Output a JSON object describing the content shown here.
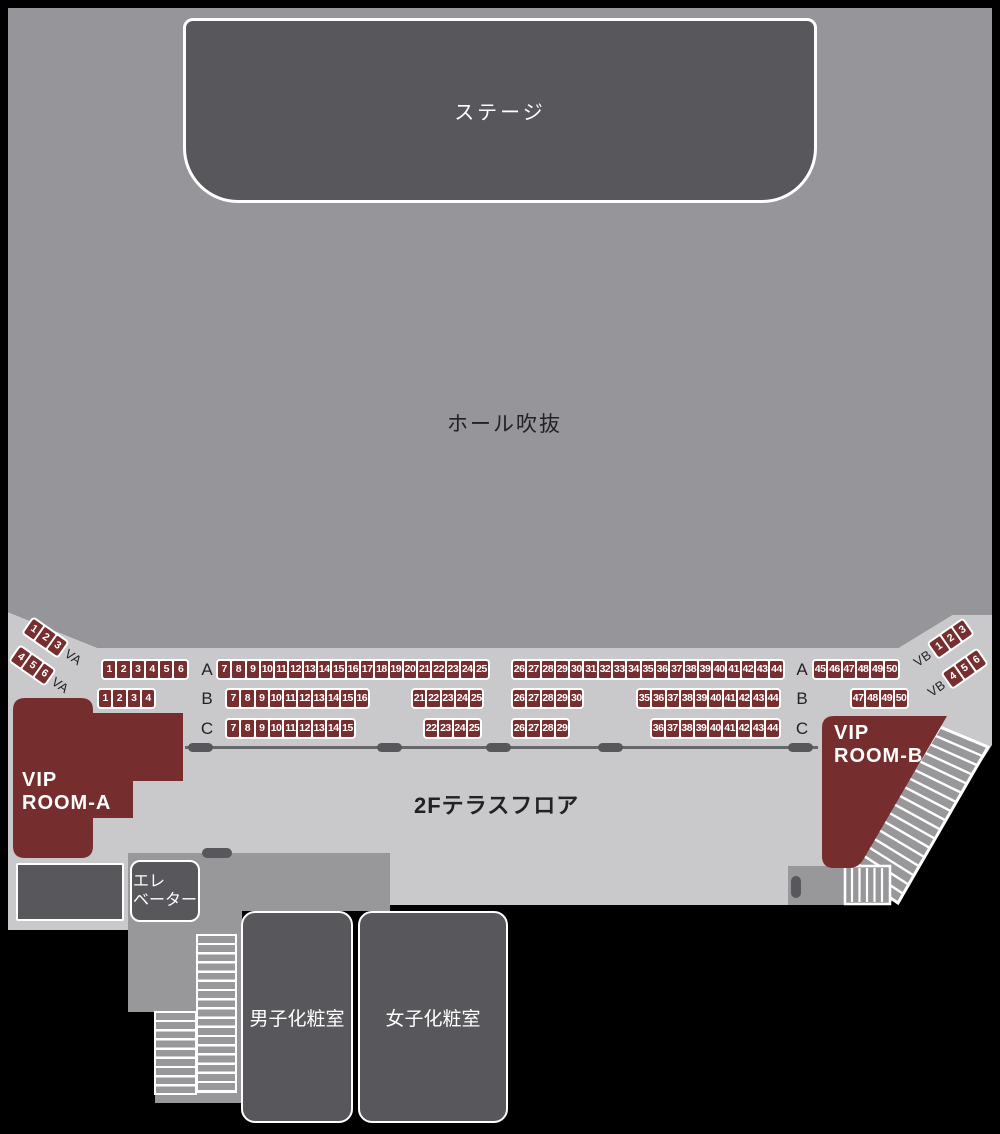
{
  "stage": {
    "label": "ステージ"
  },
  "hall": {
    "label": "ホール吹抜"
  },
  "terrace": {
    "label": "2Fテラスフロア"
  },
  "vip_room_a": {
    "line1": "VIP",
    "line2": "ROOM-A"
  },
  "vip_room_b": {
    "line1": "VIP",
    "line2": "ROOM-B"
  },
  "elevator": {
    "line1": "エレ",
    "line2": "ベーター"
  },
  "restrooms": {
    "mens_label": "男子化粧室",
    "womens_label": "女子化粧室"
  },
  "colors": {
    "background": "#000000",
    "hall_gray": "#96969a",
    "terrace_gray": "#c9c9cb",
    "floor_gray": "#98989b",
    "box_gray": "#58585c",
    "seat_red": "#772e2e",
    "vip_red": "#762d2d",
    "label_dark": "#222226",
    "white": "#ffffff"
  },
  "seat_rows": [
    {
      "row": "A",
      "label_left": "A",
      "label_right": "A",
      "blocks": [
        [
          "1",
          "2",
          "3",
          "4",
          "5",
          "6"
        ],
        [
          "7",
          "8",
          "9",
          "10",
          "11",
          "12",
          "13",
          "14",
          "15",
          "16",
          "17",
          "18",
          "19",
          "20",
          "21",
          "22",
          "23",
          "24",
          "25"
        ],
        [
          "26",
          "27",
          "28",
          "29",
          "30",
          "31",
          "32",
          "33",
          "34",
          "35",
          "36",
          "37",
          "38",
          "39",
          "40",
          "41",
          "42",
          "43",
          "44"
        ],
        [
          "45",
          "46",
          "47",
          "48",
          "49",
          "50"
        ]
      ]
    },
    {
      "row": "B",
      "label_left": "B",
      "label_right": "B",
      "blocks": [
        [
          "1",
          "2",
          "3",
          "4"
        ],
        [
          "7",
          "8",
          "9",
          "10",
          "11",
          "12",
          "13",
          "14",
          "15",
          "16"
        ],
        [
          "21",
          "22",
          "23",
          "24",
          "25"
        ],
        [
          "26",
          "27",
          "28",
          "29",
          "30"
        ],
        [
          "35",
          "36",
          "37",
          "38",
          "39",
          "40",
          "41",
          "42",
          "43",
          "44"
        ],
        [
          "47",
          "48",
          "49",
          "50"
        ]
      ]
    },
    {
      "row": "C",
      "label_left": "C",
      "label_right": "C",
      "blocks": [
        [
          "7",
          "8",
          "9",
          "10",
          "11",
          "12",
          "13",
          "14",
          "15"
        ],
        [
          "22",
          "23",
          "24",
          "25"
        ],
        [
          "26",
          "27",
          "28",
          "29"
        ],
        [
          "36",
          "37",
          "38",
          "39",
          "40",
          "41",
          "42",
          "43",
          "44"
        ]
      ]
    }
  ],
  "diagonal_seats": {
    "left": [
      {
        "seats": [
          "1",
          "2",
          "3"
        ],
        "label": "VA"
      },
      {
        "seats": [
          "4",
          "5",
          "6"
        ],
        "label": "VA"
      }
    ],
    "right": [
      {
        "label": "VB",
        "seats": [
          "1",
          "2",
          "3"
        ]
      },
      {
        "label": "VB",
        "seats": [
          "4",
          "5",
          "6"
        ]
      }
    ]
  }
}
